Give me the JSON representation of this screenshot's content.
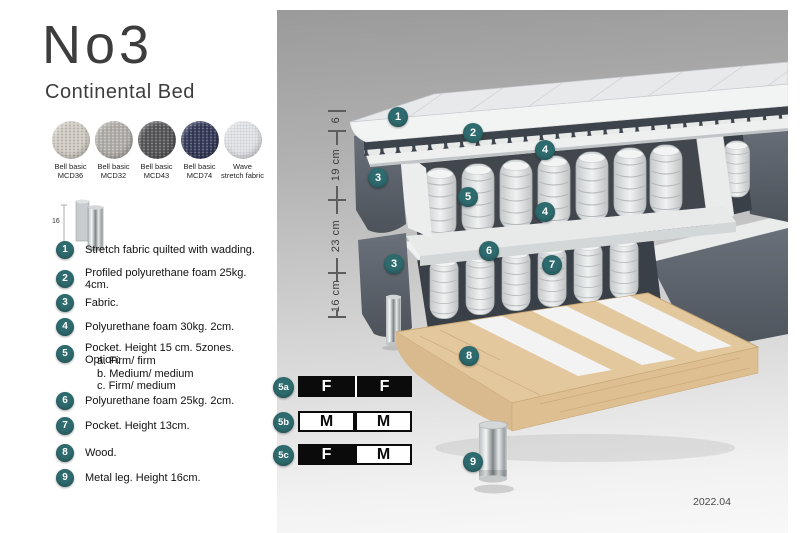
{
  "header": {
    "title": "No3",
    "subtitle": "Continental Bed"
  },
  "swatches": [
    {
      "line1": "Bell basic",
      "line2": "MCD36"
    },
    {
      "line1": "Bell basic",
      "line2": "MCD32"
    },
    {
      "line1": "Bell basic",
      "line2": "MCD43"
    },
    {
      "line1": "Bell basic",
      "line2": "MCD74"
    },
    {
      "line1": "Wave",
      "line2": "stretch fabric"
    }
  ],
  "leg_icon": {
    "height_label": "16"
  },
  "legend": {
    "items": [
      {
        "num": "1",
        "text": "Stretch fabric quilted with wadding."
      },
      {
        "num": "2",
        "text": "Profiled polyurethane foam 25kg. 4cm."
      },
      {
        "num": "3",
        "text": "Fabric."
      },
      {
        "num": "4",
        "text": "Polyurethane foam 30kg. 2cm."
      },
      {
        "num": "5",
        "text": "Pocket. Height 15 cm. 5zones. Option:",
        "options": [
          "a. Firm/ firm",
          "b. Medium/ medium",
          "c. Firm/ medium"
        ]
      },
      {
        "num": "6",
        "text": "Polyurethane foam 25kg. 2cm."
      },
      {
        "num": "7",
        "text": "Pocket. Height 13cm."
      },
      {
        "num": "8",
        "text": "Wood."
      },
      {
        "num": "9",
        "text": "Metal leg. Height 16cm."
      }
    ]
  },
  "diagram": {
    "callouts": [
      "1",
      "2",
      "4",
      "3",
      "5",
      "4",
      "6",
      "7",
      "3",
      "8",
      "9"
    ],
    "dimensions": [
      "6",
      "19 cm",
      "23 cm",
      "16 cm"
    ],
    "version": "2022.04"
  },
  "firmness": {
    "rows": [
      {
        "id": "5a",
        "cells": [
          {
            "label": "F",
            "variant": "dark"
          },
          {
            "label": "F",
            "variant": "dark"
          }
        ]
      },
      {
        "id": "5b",
        "cells": [
          {
            "label": "M",
            "variant": "light"
          },
          {
            "label": "M",
            "variant": "light"
          }
        ]
      },
      {
        "id": "5c",
        "cells": [
          {
            "label": "F",
            "variant": "dark"
          },
          {
            "label": "M",
            "variant": "light"
          }
        ]
      }
    ]
  },
  "colors": {
    "badge_teal": "#2e6b6e",
    "fabric_dark": "#565c65",
    "wood": "#e4c89d"
  }
}
